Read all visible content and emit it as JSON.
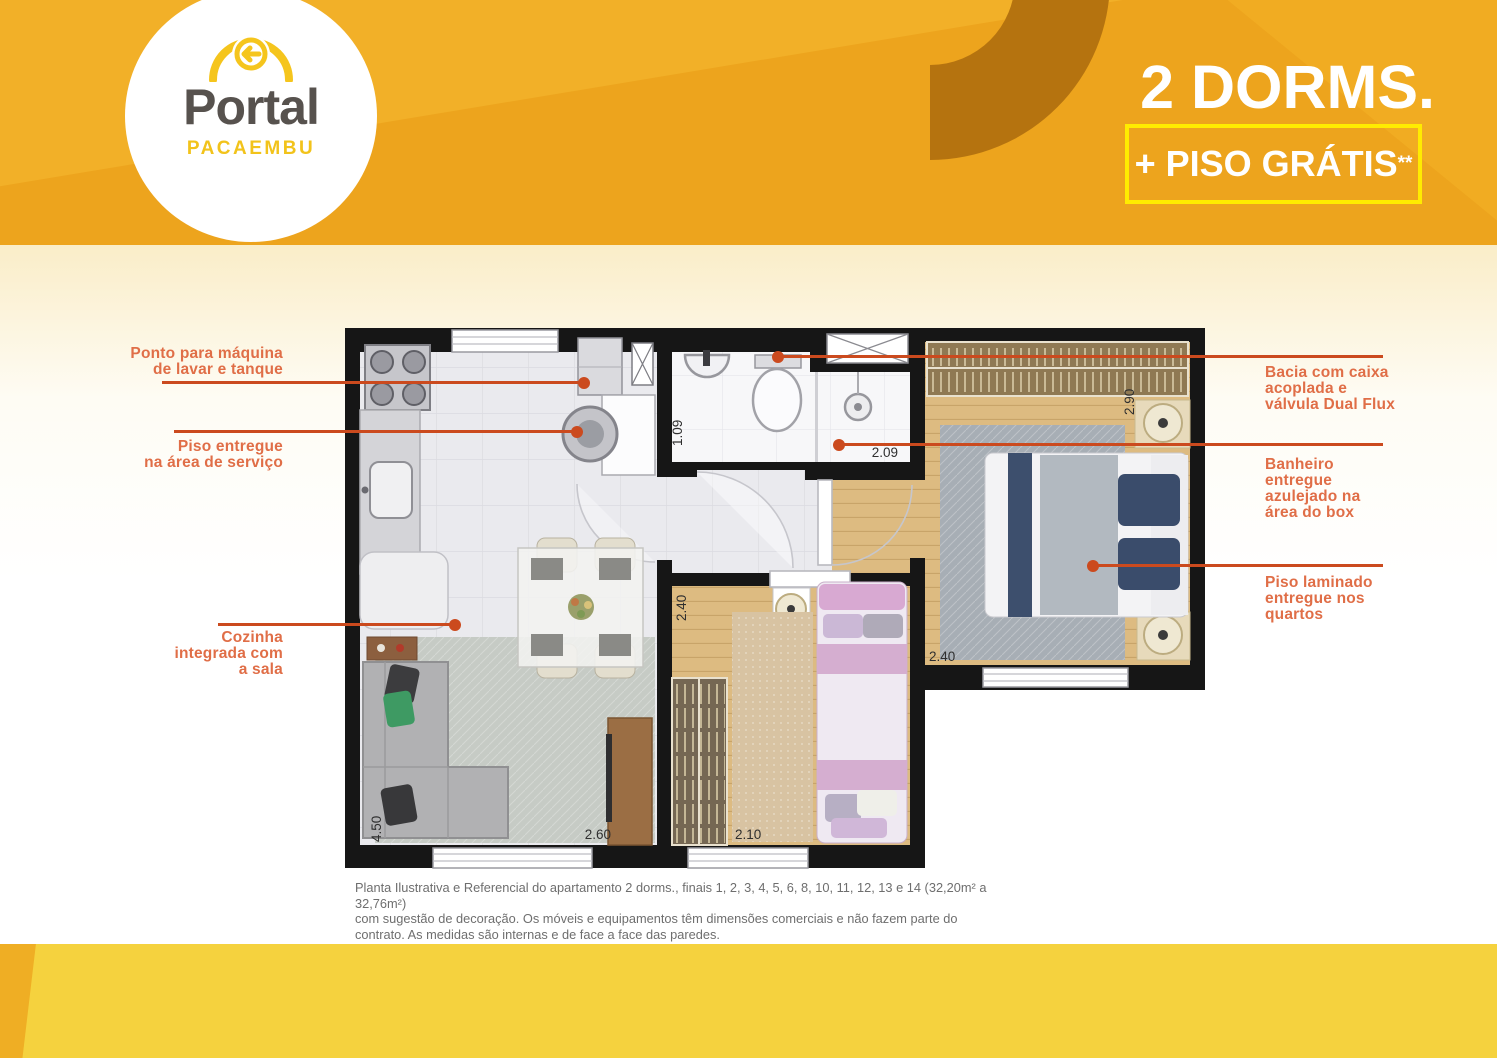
{
  "header": {
    "logo_brand": "Portal",
    "logo_sub": "PACAEMBU",
    "title": "2 DORMS.",
    "promo": "+ PISO GRÁTIS",
    "promo_sup": "**"
  },
  "callouts": {
    "left": [
      {
        "lines": [
          "Ponto para máquina",
          "de lavar e tanque"
        ]
      },
      {
        "lines": [
          "Piso entregue",
          "na área de serviço"
        ]
      },
      {
        "lines": [
          "Cozinha",
          "integrada com",
          "a sala"
        ]
      }
    ],
    "right": [
      {
        "lines": [
          "Bacia com caixa",
          "acoplada e",
          "válvula Dual Flux"
        ]
      },
      {
        "lines": [
          "Banheiro",
          "entregue",
          "azulejado na",
          "área do box"
        ]
      },
      {
        "lines": [
          "Piso laminado",
          "entregue nos",
          "quartos"
        ]
      }
    ]
  },
  "floorplan": {
    "dims": {
      "bath": "1.09",
      "shower": "2.09",
      "bedroom1_depth": "2.90",
      "bedroom1_width": "2.40",
      "bedroom2_depth": "2.40",
      "bedroom2_width": "2.10",
      "living_depth": "4.50",
      "living_width": "2.60"
    }
  },
  "disclaimer": {
    "line1": "Planta Ilustrativa e Referencial do apartamento 2 dorms., finais 1, 2, 3, 4, 5, 6, 8, 10, 11, 12, 13 e 14 (32,20m² a 32,76m²)",
    "line2": "com sugestão de decoração. Os móveis e equipamentos têm dimensões comerciais e não fazem parte do",
    "line3": "contrato. As medidas são internas e de face a face das paredes.",
    "line4": "(**) Piso entregue na área de serviço e dormitórios."
  },
  "colors": {
    "header_orange": "#EDA41D",
    "arc_brown": "#B5730F",
    "promo_border_yellow": "#FFEC00",
    "footer_yellow": "#F5D23E",
    "callout_line": "#CB4A1E",
    "callout_text": "#E06E47",
    "wall_black": "#161616",
    "wood_floor": "#DDBB81"
  }
}
